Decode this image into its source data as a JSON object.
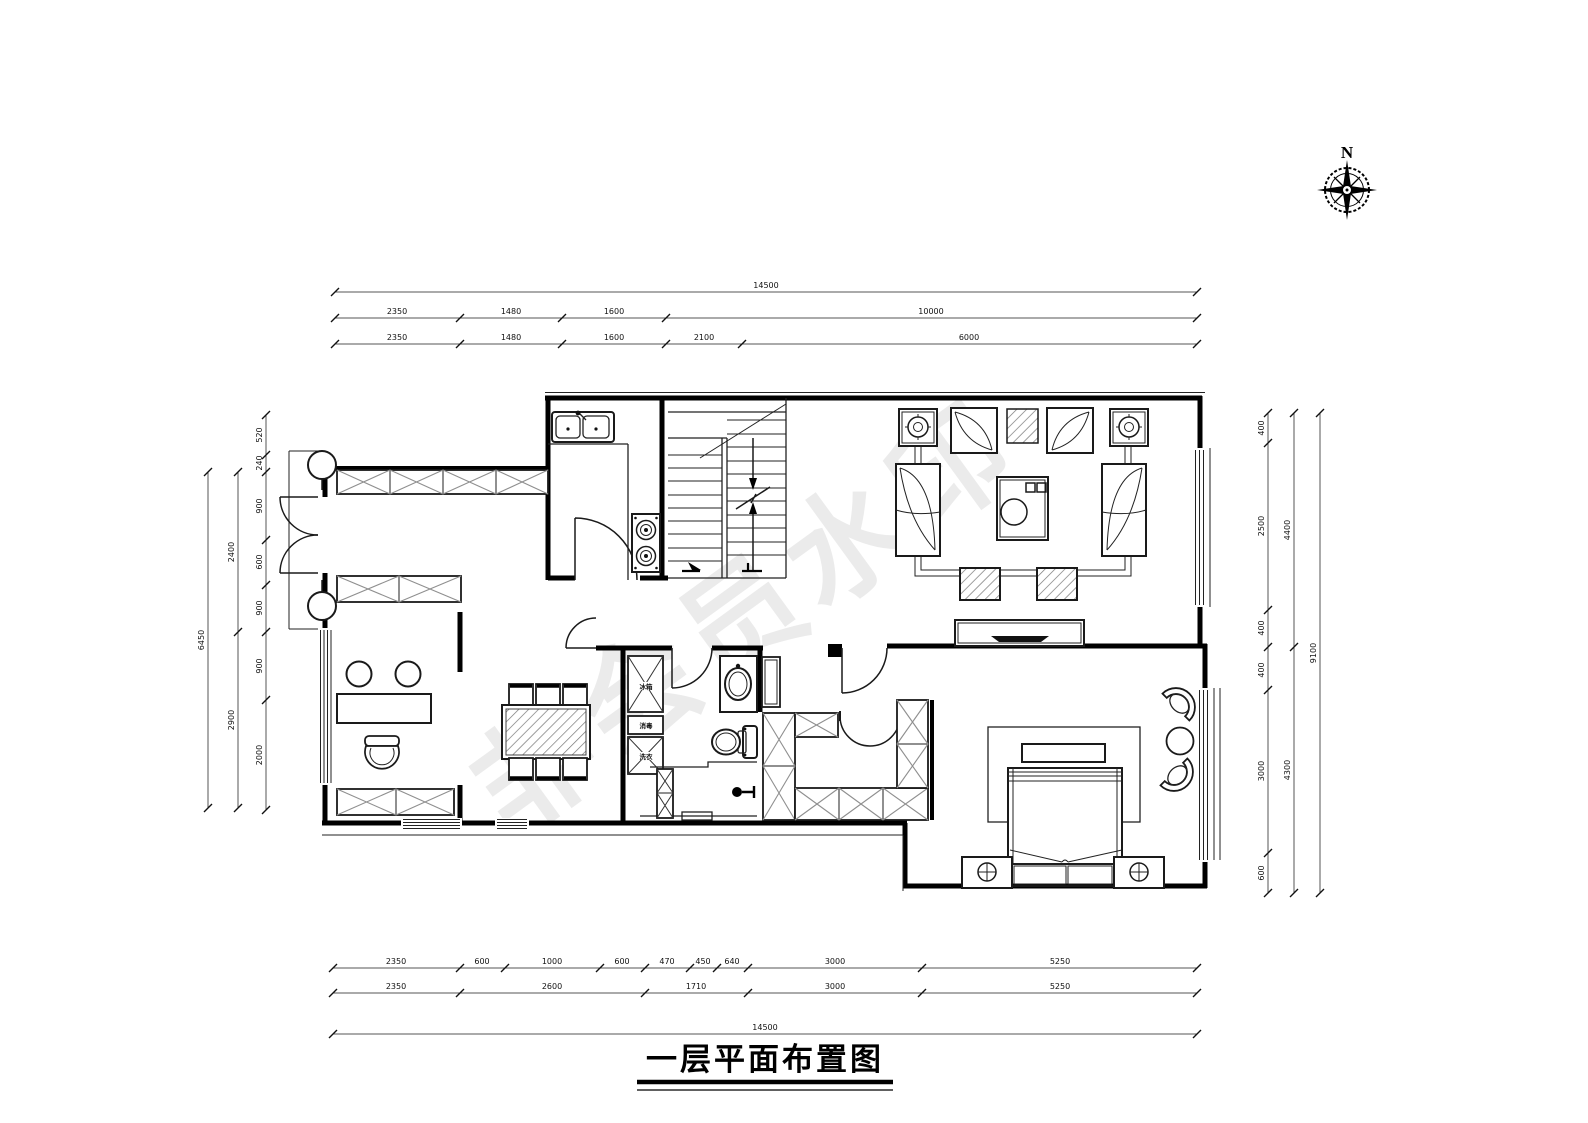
{
  "meta": {
    "compass_label": "N",
    "watermark": "非会员水印",
    "title": "一层平面布置图"
  },
  "dimensions": {
    "top": {
      "row1": [
        "14500"
      ],
      "row2": [
        "2350",
        "1480",
        "1600",
        "10000"
      ],
      "row3": [
        "2350",
        "1480",
        "1600",
        "2100",
        "6000"
      ]
    },
    "bottom": {
      "row1": [
        "2350",
        "600",
        "1000",
        "600",
        "470",
        "450",
        "640",
        "3000",
        "5250"
      ],
      "row2": [
        "2350",
        "2600",
        "1710",
        "3000",
        "5250"
      ],
      "row3": [
        "14500"
      ]
    },
    "left": {
      "inner": [
        "520",
        "240",
        "900",
        "600",
        "900",
        "900",
        "2000"
      ],
      "middle": [
        "2400",
        "2900"
      ],
      "outer": [
        "6450"
      ]
    },
    "right": {
      "inner": [
        "400",
        "2500",
        "400",
        "400",
        "3000",
        "600"
      ],
      "middle": [
        "4400",
        "4300"
      ],
      "outer": [
        "9100"
      ]
    }
  },
  "labels": {
    "appliance_top": "冰箱",
    "appliance_mid": "消毒",
    "appliance_bottom": "洗衣"
  }
}
